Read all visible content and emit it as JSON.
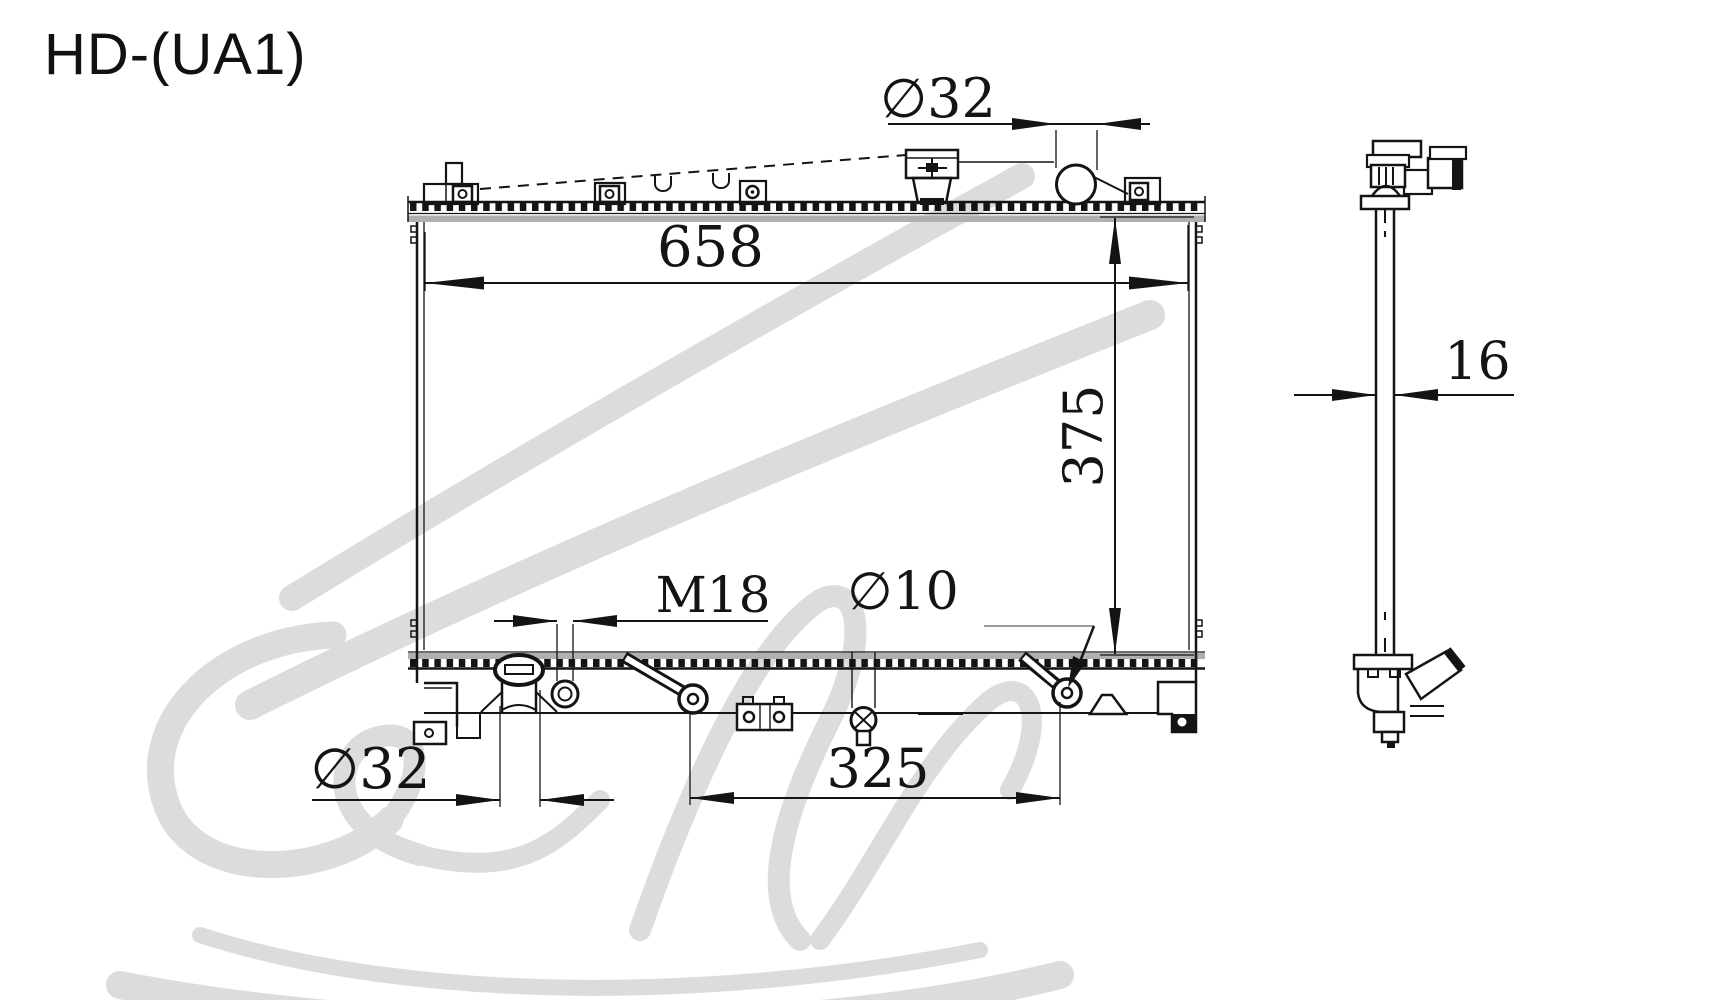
{
  "labels": {
    "part_code": "HD-(UA1)",
    "dim_top_inlet_diameter": "∅32",
    "dim_core_width": "658",
    "dim_core_height": "375",
    "dim_drain_thread": "M18",
    "dim_mount_hole": "∅10",
    "dim_bottom_outlet_diameter": "∅32",
    "dim_bottom_span": "325",
    "dim_core_thickness": "16"
  },
  "colors": {
    "line": "#141414",
    "header_band": "#b0b0b0",
    "watermark": "#dcdcdc",
    "leader_gray": "#9a9a9a",
    "background": "#ffffff"
  }
}
